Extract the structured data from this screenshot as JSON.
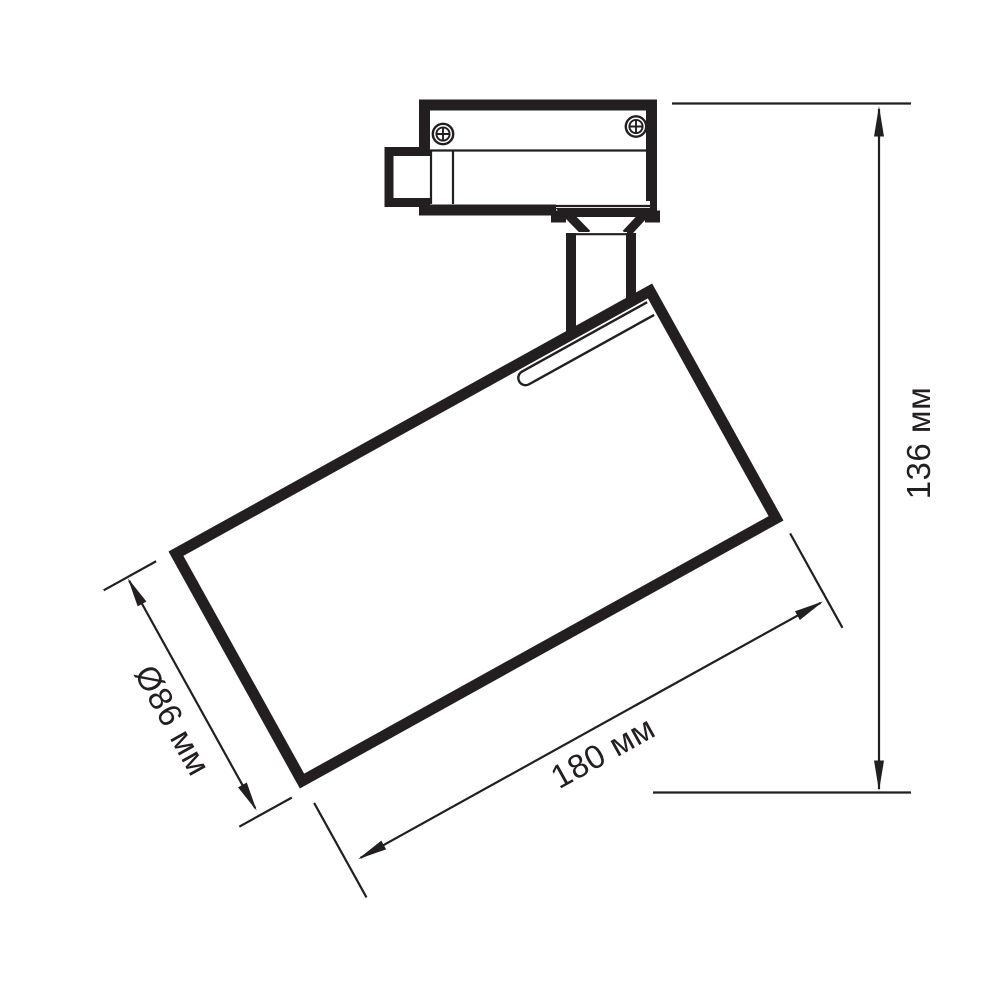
{
  "drawing": {
    "background_color": "#ffffff",
    "line_color": "#231f20",
    "labels": {
      "height": "136 мм",
      "length": "180 мм",
      "diameter": "Ø86 мм"
    }
  }
}
